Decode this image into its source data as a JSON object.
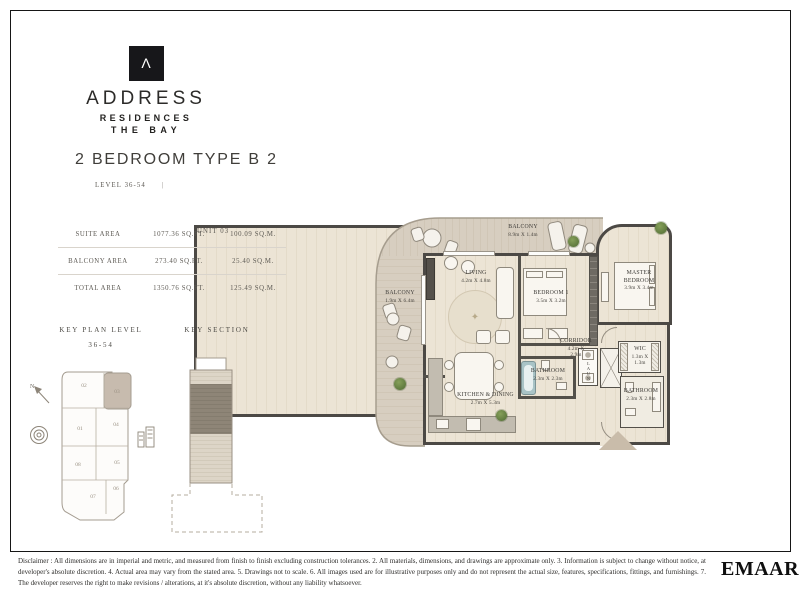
{
  "brand": {
    "glyph": "Λ",
    "name": "ADDRESS",
    "line1": "RESIDENCES",
    "line2": "THE BAY"
  },
  "header": {
    "title": "2 BEDROOM TYPE B 2",
    "level": "LEVEL 36-54",
    "separator": "|",
    "unit": "UNIT 03"
  },
  "area_table": {
    "rows": [
      {
        "label": "SUITE AREA",
        "sqft": "1077.36 SQ.FT.",
        "sqm": "100.09 SQ.M."
      },
      {
        "label": "BALCONY AREA",
        "sqft": "273.40 SQ.FT.",
        "sqm": "25.40 SQ.M."
      },
      {
        "label": "TOTAL AREA",
        "sqft": "1350.76 SQ.FT.",
        "sqm": "125.49 SQ.M."
      }
    ]
  },
  "key_plan": {
    "heading": "KEY PLAN LEVEL",
    "level_range": "36-54",
    "north": "N",
    "units": [
      "01",
      "02",
      "03",
      "04",
      "05",
      "06",
      "07",
      "08"
    ],
    "highlighted_unit": "03"
  },
  "key_section": {
    "heading": "KEY SECTION"
  },
  "floor_plan": {
    "balcony_top": {
      "name": "BALCONY",
      "dims": "8.9m X 1.4m"
    },
    "balcony_left": {
      "name": "BALCONY",
      "dims": "1.9m X 6.4m"
    },
    "living": {
      "name": "LIVING",
      "dims": "4.2m X 4.8m"
    },
    "bedroom1": {
      "name": "BEDROOM 1",
      "dims": "3.5m X 3.2m"
    },
    "master": {
      "name": "MASTER BEDROOM",
      "dims": "3.9m X 3.4m"
    },
    "corridor": {
      "name": "CORRIDOR",
      "dims": "4.2m X 2.9m"
    },
    "bathroom1": {
      "name": "BATHROOM",
      "dims": "2.3m X 2.3m"
    },
    "wic": {
      "name": "WIC",
      "dims": "1.3m X 1.3m"
    },
    "bathroom2": {
      "name": "BATHROOM",
      "dims": "2.3m X 2.8m"
    },
    "kitchen": {
      "name": "KITCHEN & DINING",
      "dims": "2.7m X 5.3m"
    },
    "laundry": {
      "name": "LAUN"
    }
  },
  "footer": {
    "disclaimer": "Disclaimer : All dimensions are in imperial and metric, and measured from finish to finish excluding construction tolerances. 2. All materials, dimensions, and drawings are approximate only. 3. Information is subject to change without notice, at developer's absolute discretion. 4. Actual area may vary from the stated area. 5. Drawings not to scale. 6. All images used are for illustrative purposes only and do not represent the actual size, features, specifications, fittings, and furnishings. 7. The developer reserves the right to make revisions / alterations, at it's absolute discretion, without any liability whatsoever.",
    "developer": "EMAAR"
  },
  "colors": {
    "wall": "#4c4945",
    "floor": "#ece4d5",
    "deck": "#d7cec0",
    "key_highlight": "#c7bbae",
    "section_band_dark": "#8e8577",
    "section_band_light": "#ddd5c7",
    "entry_marker": "#c9bcaa",
    "logo_black": "#17171a"
  }
}
